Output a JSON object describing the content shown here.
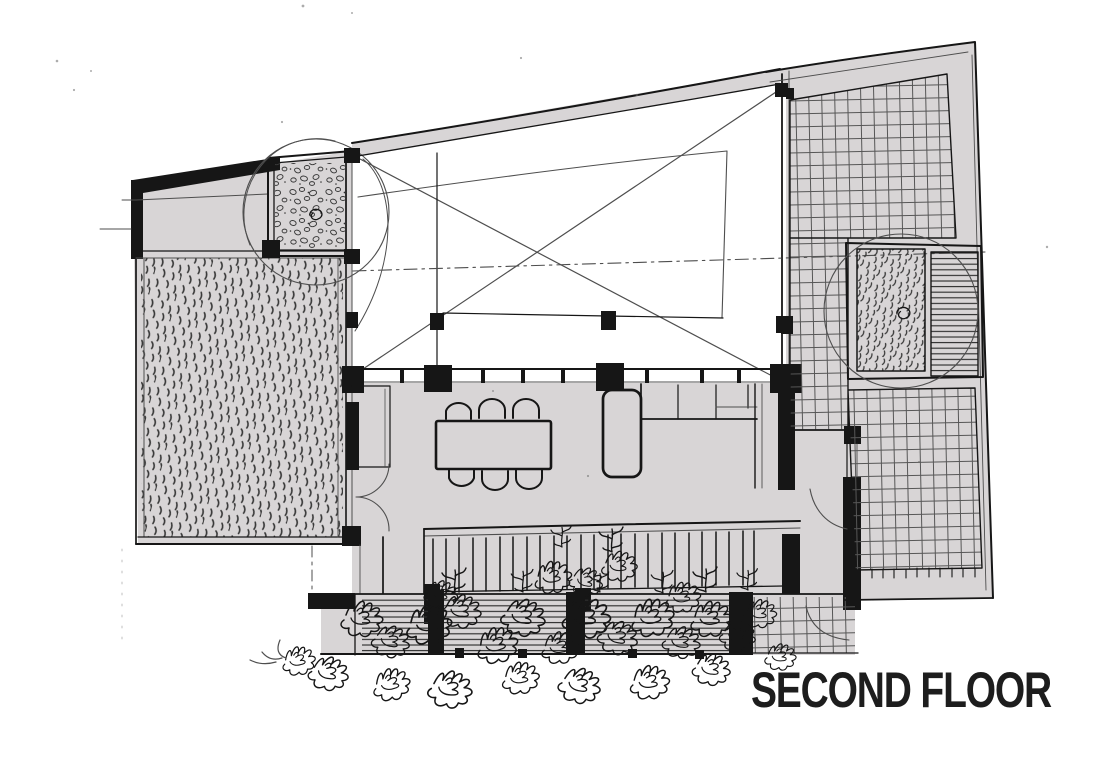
{
  "title": {
    "text": "SECOND FLOOR"
  },
  "colors": {
    "paper": "#ffffff",
    "floor_fill": "#d8d5d6",
    "ink": "#161616",
    "pencil": "#4e4e4e",
    "title_color": "#1d1d1d"
  }
}
